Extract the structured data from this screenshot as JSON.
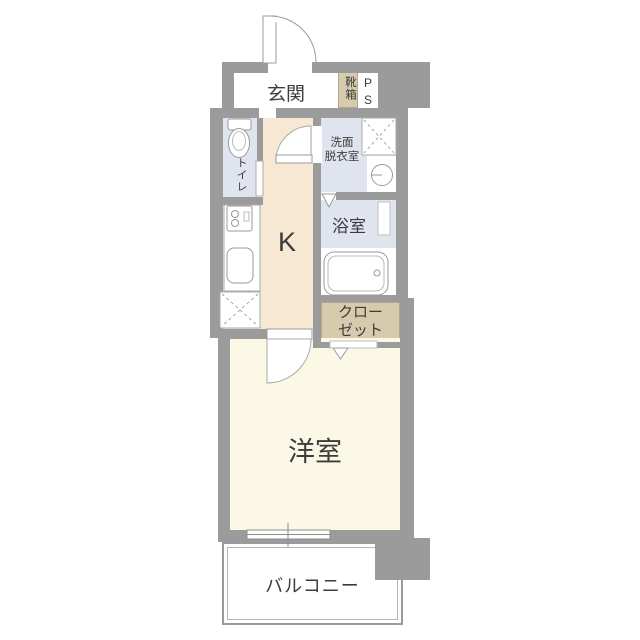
{
  "plan_type": "japanese-apartment-floor-plan",
  "rooms": {
    "genkan": {
      "label": "玄関"
    },
    "shoebox": {
      "label": "靴箱"
    },
    "pipe_space": {
      "label": "PS"
    },
    "toilet": {
      "label": "トイレ"
    },
    "kitchen": {
      "label": "K"
    },
    "washroom": {
      "line1": "洗面",
      "line2": "脱衣室"
    },
    "bathroom": {
      "label": "浴室"
    },
    "closet": {
      "line1": "クロー",
      "line2": "ゼット"
    },
    "western_room": {
      "label": "洋室"
    },
    "balcony": {
      "label": "バルコニー"
    }
  },
  "colors": {
    "wall": "#9b9b9b",
    "kitchen_floor": "#f6e8d2",
    "western_room_floor": "#fbf8e6",
    "wet_area_floor": "#dfe4ee",
    "storage_fill": "#d7cbad",
    "fixture_outline": "#999999",
    "text": "#3c3c3c"
  },
  "fixtures": [
    "entrance-door-icon",
    "toilet-icon",
    "stove-icon",
    "kitchen-sink-icon",
    "refrigerator-space-icon",
    "washing-machine-space-icon",
    "wash-basin-icon",
    "bathtub-icon",
    "door-swing-icon",
    "folding-door-icon",
    "sliding-window-icon"
  ]
}
